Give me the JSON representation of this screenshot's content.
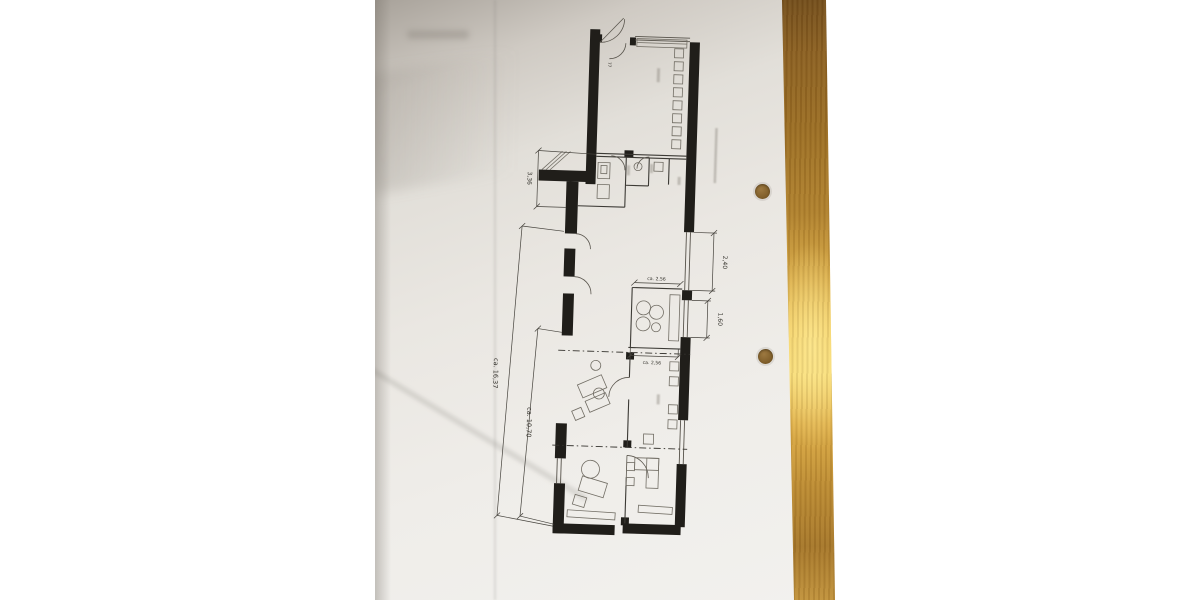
{
  "document": {
    "kind": "photographed architectural floor plan on a wooden table",
    "paper_color": "#eae7e2",
    "wood_color": "#b0812e",
    "wood_glare_color": "#f6d870",
    "ink_color": "#201e1a"
  },
  "plan": {
    "door_label": "77",
    "dimensions": [
      {
        "id": "dim-336",
        "label": "3,36"
      },
      {
        "id": "dim-240",
        "label": "2,40"
      },
      {
        "id": "dim-160",
        "label": "1,60"
      },
      {
        "id": "dim-256-top",
        "label": "ca. 2,56"
      },
      {
        "id": "dim-256-bottom",
        "label": "ca. 2,56"
      },
      {
        "id": "dim-1637",
        "label": "ca. 16,37"
      },
      {
        "id": "dim-1070",
        "label": "ca. 10,70"
      }
    ]
  }
}
